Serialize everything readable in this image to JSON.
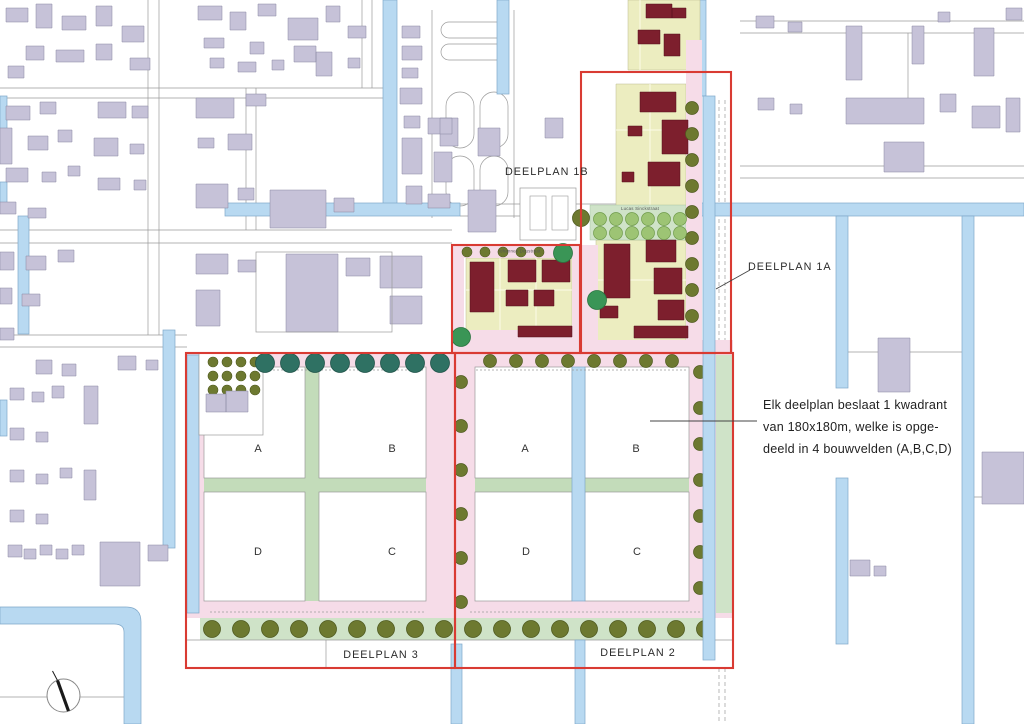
{
  "map": {
    "title_labels": {
      "deelplan_1a": "DEELPLAN 1A",
      "deelplan_1b": "DEELPLAN 1B",
      "deelplan_2": "DEELPLAN 2",
      "deelplan_3": "DEELPLAN 3"
    },
    "streets": {
      "lucas_sinckstraat": "Lucas Sinckstraat",
      "johannes_doustraat": "Johannes Doustraat"
    },
    "quadrants": {
      "d3": {
        "a": "A",
        "b": "B",
        "c": "C",
        "d": "D"
      },
      "d2": {
        "a": "A",
        "b": "B",
        "c": "C",
        "d": "D"
      }
    },
    "annotation": {
      "line1": "Elk deelplan beslaat 1 kwadrant",
      "line2": "van 180x180m, welke is opge-",
      "line3": "deeld in 4 bouwvelden (A,B,C,D)"
    },
    "colors": {
      "canal": "#b8d9f1",
      "canal_edge": "#7fa8c9",
      "existing": "#c6c2d8",
      "existing_edge": "#8886a0",
      "new": "#7d1f2d",
      "new_edge": "#55101c",
      "plot": "#ecedc0",
      "plot_edge": "#b9b98f",
      "road": "#f6dce8",
      "green": "#cfe3c8",
      "green_band": "#c3dcba",
      "tree_teal": "#2f7163",
      "tree_olive": "#6d7930",
      "tree_light": "#9dc474",
      "tree_green": "#3a9556",
      "red": "#d93b33",
      "grey": "#9a9a9a"
    }
  }
}
